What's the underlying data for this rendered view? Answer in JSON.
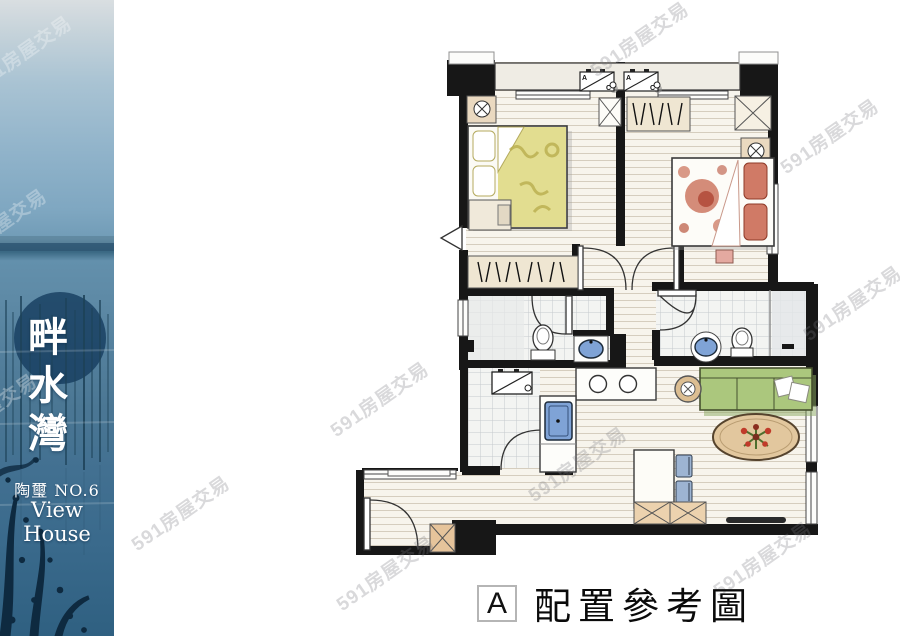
{
  "sidebar": {
    "title_chars": [
      "畔",
      "水",
      "灣"
    ],
    "subtitle": "陶璽 NO.6",
    "subtitle_en": "View House"
  },
  "watermark": {
    "text": "591房屋交易"
  },
  "caption": {
    "badge": "A",
    "label": "配置參考圖"
  },
  "plan": {
    "ac_unit_label_a": "A",
    "ac_unit_label_c": "C"
  },
  "colors": {
    "wall": "#171717",
    "floor": "#f6f3ec",
    "tile": "#f2f3f1",
    "sofa_green": "#abc77d",
    "bed1_blanket": "#ddd77e",
    "bed2_blanket": "#cf7a64",
    "sink_blue": "#7fa3d6",
    "rug_tan": "#e2c79e",
    "cabinet_tan": "#ecd2ae",
    "photo_sky": "#a9c3d3",
    "photo_water": "#4b7794"
  }
}
